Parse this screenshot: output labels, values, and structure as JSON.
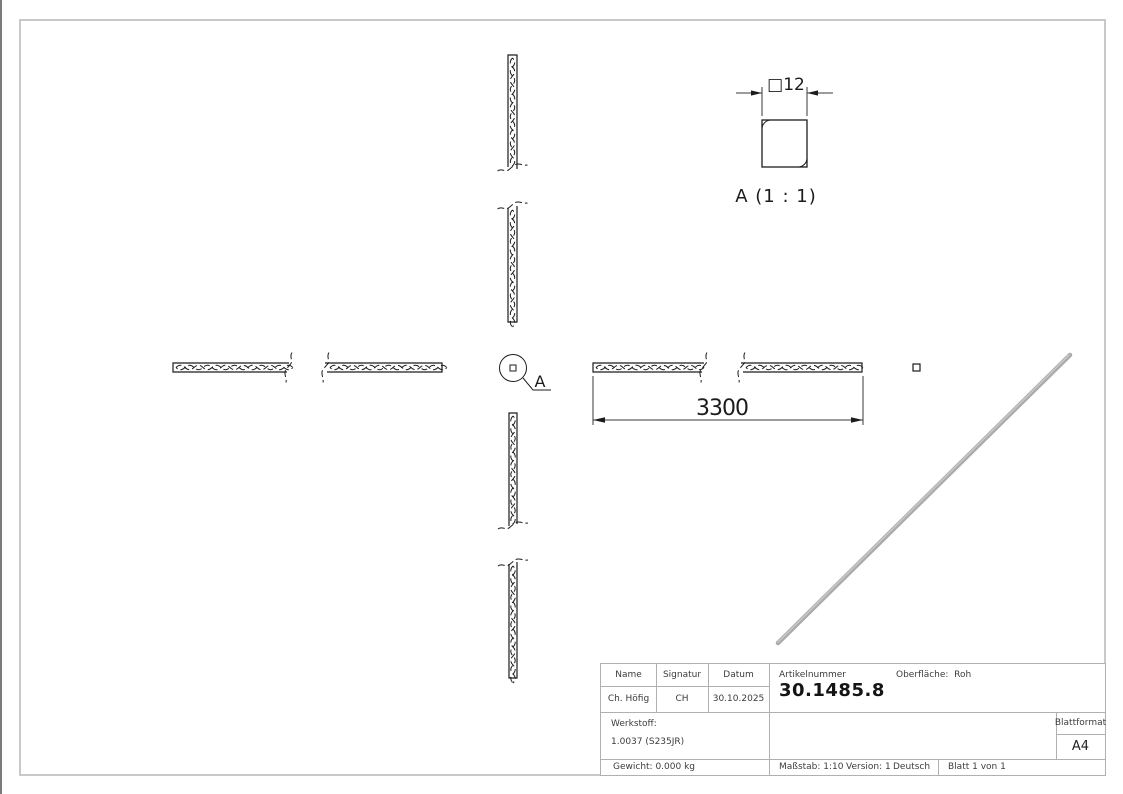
{
  "drawing": {
    "detail_dimension": "□12",
    "detail_view_label": "A (1 : 1)",
    "callout_label": "A",
    "length_dimension": "3300"
  },
  "title_block": {
    "headers": {
      "name": "Name",
      "signatur": "Signatur",
      "datum": "Datum",
      "artikelnummer": "Artikelnummer",
      "oberflaeche": "Oberfläche:  Roh",
      "blattformat": "Blattformat",
      "werkstoff": "Werkstoff:"
    },
    "values": {
      "name": "Ch. Höfig",
      "signatur": "CH",
      "datum": "30.10.2025",
      "artikelnummer": "30.1485.8",
      "blattformat": "A4",
      "werkstoff": "1.0037 (S235JR)"
    },
    "footer": {
      "gewicht": "Gewicht: 0.000 kg",
      "massstab": "Maßstab: 1:10",
      "version": "Version: 1",
      "sprache": "Deutsch",
      "blatt": "Blatt 1 von 1"
    }
  },
  "colors": {
    "line": "#1c1c1c",
    "frame": "#c9c9c9",
    "title_block_lines": "#b0b0b0",
    "isometric_bar": "#ababab",
    "background": "#ffffff"
  }
}
